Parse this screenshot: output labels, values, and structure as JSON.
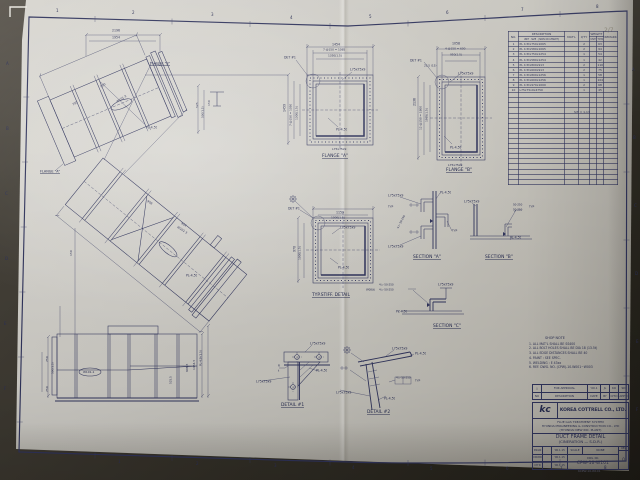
{
  "sheet": {
    "type": "engineering-drawing-photo",
    "border_color": "#30345c",
    "paper_color": "#ceccc6",
    "background_color": "#3a362e"
  },
  "view_labels": [
    {
      "name": "flange-a-label",
      "t": "FLANGE \"A\"",
      "x": 322,
      "y": 154,
      "fs": 4.4
    },
    {
      "name": "flange-b-label",
      "t": "FLANGE \"B\"",
      "x": 446,
      "y": 168,
      "fs": 4.4
    },
    {
      "name": "typ-stiff-detail-label",
      "t": "TYP.STIFF. DETAIL",
      "x": 312,
      "y": 293,
      "fs": 4.4
    },
    {
      "name": "section-a-label",
      "t": "SECTION \"A\"",
      "x": 413,
      "y": 255,
      "fs": 4.4
    },
    {
      "name": "section-b-label",
      "t": "SECTION \"B\"",
      "x": 485,
      "y": 255,
      "fs": 4.4
    },
    {
      "name": "section-c-label",
      "t": "SECTION \"C\"",
      "x": 433,
      "y": 324,
      "fs": 4.4
    },
    {
      "name": "detail-1-label",
      "t": "DETAIL #1",
      "x": 281,
      "y": 403,
      "fs": 4.4
    },
    {
      "name": "detail-2-label",
      "t": "DETAIL #2",
      "x": 367,
      "y": 410,
      "fs": 4.4
    },
    {
      "name": "main-flange-a-callout",
      "t": "FLANGE \"A\"",
      "x": 40,
      "y": 170,
      "fs": 3.4
    },
    {
      "name": "main-flange-b-callout",
      "t": "FLANGE \"B\"",
      "x": 150,
      "y": 62,
      "fs": 3.4
    }
  ],
  "annotations": [
    {
      "t": "1",
      "x": 56,
      "y": 9,
      "fs": 4
    },
    {
      "t": "2",
      "x": 132,
      "y": 11,
      "fs": 4
    },
    {
      "t": "3",
      "x": 211,
      "y": 13,
      "fs": 4
    },
    {
      "t": "4",
      "x": 290,
      "y": 16,
      "fs": 4
    },
    {
      "t": "5",
      "x": 369,
      "y": 15,
      "fs": 4
    },
    {
      "t": "6",
      "x": 446,
      "y": 11,
      "fs": 4
    },
    {
      "t": "7",
      "x": 521,
      "y": 8,
      "fs": 4
    },
    {
      "t": "8",
      "x": 596,
      "y": 5,
      "fs": 4
    },
    {
      "t": "1",
      "x": 118,
      "y": 460,
      "fs": 4
    },
    {
      "t": "2",
      "x": 196,
      "y": 462,
      "fs": 4
    },
    {
      "t": "3",
      "x": 274,
      "y": 464,
      "fs": 4
    },
    {
      "t": "4",
      "x": 352,
      "y": 466,
      "fs": 4
    },
    {
      "t": "5",
      "x": 430,
      "y": 467,
      "fs": 4
    },
    {
      "t": "6",
      "x": 506,
      "y": 467,
      "fs": 4
    },
    {
      "t": "7",
      "x": 560,
      "y": 467,
      "fs": 4
    },
    {
      "t": "8",
      "x": 604,
      "y": 466,
      "fs": 4
    },
    {
      "t": "A",
      "x": 6,
      "y": 62,
      "fs": 4
    },
    {
      "t": "B",
      "x": 6,
      "y": 127,
      "fs": 4
    },
    {
      "t": "C",
      "x": 5,
      "y": 192,
      "fs": 4
    },
    {
      "t": "D",
      "x": 5,
      "y": 257,
      "fs": 4
    },
    {
      "t": "E",
      "x": 4,
      "y": 322,
      "fs": 4
    },
    {
      "t": "F",
      "x": 4,
      "y": 387,
      "fs": 4
    },
    {
      "t": "A",
      "x": 632,
      "y": 68,
      "fs": 4
    },
    {
      "t": "B",
      "x": 633,
      "y": 136,
      "fs": 4
    },
    {
      "t": "C",
      "x": 634,
      "y": 204,
      "fs": 4
    },
    {
      "t": "D",
      "x": 635,
      "y": 272,
      "fs": 4
    },
    {
      "t": "E",
      "x": 636,
      "y": 340,
      "fs": 4
    },
    {
      "t": "F",
      "x": 636,
      "y": 408,
      "fs": 4
    },
    {
      "t": "2/7",
      "x": 604,
      "y": 27,
      "fs": 6,
      "c": "#8f8a7c"
    },
    {
      "t": "2196",
      "x": 112,
      "y": 29,
      "fs": 3.2
    },
    {
      "t": "1954",
      "x": 112,
      "y": 36,
      "fs": 3.2
    },
    {
      "t": "PL-4.5t",
      "x": 146,
      "y": 126,
      "fs": 3.2
    },
    {
      "t": "525",
      "x": 196,
      "y": 108,
      "r": -90,
      "fs": 3
    },
    {
      "t": "500(1.5)",
      "x": 202,
      "y": 118,
      "r": -90,
      "fs": 2.8
    },
    {
      "t": "150",
      "x": 208,
      "y": 106,
      "r": -90,
      "fs": 3
    },
    {
      "t": "W101-2",
      "x": 116,
      "y": 101,
      "r": -33,
      "fs": 3
    },
    {
      "t": "W101-3",
      "x": 178,
      "y": 226,
      "r": 33,
      "fs": 3
    },
    {
      "t": "750",
      "x": 72,
      "y": 104,
      "r": -33,
      "fs": 3
    },
    {
      "t": "500",
      "x": 100,
      "y": 86,
      "r": -33,
      "fs": 3
    },
    {
      "t": "908",
      "x": 148,
      "y": 200,
      "r": 33,
      "fs": 3
    },
    {
      "t": "924",
      "x": 182,
      "y": 222,
      "r": 33,
      "fs": 3
    },
    {
      "t": "PL-4.5t",
      "x": 186,
      "y": 274,
      "fs": 3.2
    },
    {
      "t": "1454",
      "x": 332,
      "y": 43,
      "fs": 3.2
    },
    {
      "t": "7 @150 = 1085",
      "x": 323,
      "y": 49,
      "fs": 2.9
    },
    {
      "t": "1350(1.5)",
      "x": 328,
      "y": 55,
      "fs": 2.9
    },
    {
      "t": "DET #1",
      "x": 284,
      "y": 56,
      "fs": 3.2
    },
    {
      "t": "L75x75x9",
      "x": 350,
      "y": 68,
      "fs": 3.2
    },
    {
      "t": "1459",
      "x": 283,
      "y": 112,
      "r": -90,
      "fs": 3.2
    },
    {
      "t": "7 @150 = 1050",
      "x": 290,
      "y": 126,
      "r": -90,
      "fs": 2.9
    },
    {
      "t": "1300(1.5)",
      "x": 296,
      "y": 120,
      "r": -90,
      "fs": 2.9
    },
    {
      "t": "PL-4.5t",
      "x": 336,
      "y": 128,
      "fs": 3.2
    },
    {
      "t": "L75x75x9",
      "x": 332,
      "y": 148,
      "fs": 3
    },
    {
      "t": "1058",
      "x": 452,
      "y": 42,
      "fs": 3.2
    },
    {
      "t": "4 @150 = 600",
      "x": 445,
      "y": 48,
      "fs": 2.9
    },
    {
      "t": "950(1.5)",
      "x": 450,
      "y": 54,
      "fs": 2.9
    },
    {
      "t": "DET #1",
      "x": 410,
      "y": 59,
      "fs": 3.2
    },
    {
      "t": "25.5 (15)",
      "x": 424,
      "y": 65,
      "fs": 2.8
    },
    {
      "t": "L75x75x9",
      "x": 458,
      "y": 72,
      "fs": 3.2
    },
    {
      "t": "2136",
      "x": 413,
      "y": 106,
      "r": -90,
      "fs": 3.2
    },
    {
      "t": "12 @150 = 1800",
      "x": 420,
      "y": 130,
      "r": -90,
      "fs": 2.9
    },
    {
      "t": "1985(1.5)",
      "x": 426,
      "y": 122,
      "r": -90,
      "fs": 2.9
    },
    {
      "t": "PL-4.5t",
      "x": 450,
      "y": 146,
      "fs": 3.2
    },
    {
      "t": "L75x75x9",
      "x": 448,
      "y": 164,
      "fs": 3
    },
    {
      "t": "1159",
      "x": 336,
      "y": 211,
      "fs": 3.2
    },
    {
      "t": "1000(1.5)",
      "x": 331,
      "y": 217,
      "fs": 2.9
    },
    {
      "t": "DET #1",
      "x": 288,
      "y": 207,
      "fs": 3.2
    },
    {
      "t": "L75x75x9",
      "x": 340,
      "y": 226,
      "fs": 3.2
    },
    {
      "t": "970",
      "x": 293,
      "y": 252,
      "r": -90,
      "fs": 3.2
    },
    {
      "t": "1000(1.5)",
      "x": 299,
      "y": 260,
      "r": -90,
      "fs": 2.9
    },
    {
      "t": "PL-4.5t",
      "x": 338,
      "y": 266,
      "fs": 3.2
    },
    {
      "t": "L75x75x9",
      "x": 388,
      "y": 194,
      "fs": 3.2
    },
    {
      "t": "PL-4.5t",
      "x": 440,
      "y": 191,
      "fs": 3.2
    },
    {
      "t": "TYP",
      "x": 388,
      "y": 206,
      "fs": 2.9
    },
    {
      "t": "TYP",
      "x": 452,
      "y": 230,
      "fs": 2.9
    },
    {
      "t": "4 ▷ 50-250",
      "x": 397,
      "y": 228,
      "r": -62,
      "fs": 2.7
    },
    {
      "t": "L75x75x9",
      "x": 388,
      "y": 245,
      "fs": 3.2
    },
    {
      "t": "L75x75x9",
      "x": 464,
      "y": 200,
      "fs": 3.2
    },
    {
      "t": "50-250",
      "x": 513,
      "y": 204,
      "fs": 2.7
    },
    {
      "t": "50-250",
      "x": 513,
      "y": 209,
      "fs": 2.7
    },
    {
      "t": "TYP",
      "x": 529,
      "y": 206,
      "fs": 2.9
    },
    {
      "t": "PL-4.5t",
      "x": 510,
      "y": 236,
      "fs": 3.2
    },
    {
      "t": "W08(t)",
      "x": 366,
      "y": 289,
      "fs": 2.7
    },
    {
      "t": "4 ▷ 50-250",
      "x": 379,
      "y": 284,
      "fs": 2.7
    },
    {
      "t": "4 ▷ 50-250",
      "x": 379,
      "y": 289,
      "fs": 2.7
    },
    {
      "t": "L75x75x9",
      "x": 438,
      "y": 283,
      "fs": 3.2
    },
    {
      "t": "PL-4.5t",
      "x": 396,
      "y": 310,
      "fs": 3.2
    },
    {
      "t": "L75x75x9",
      "x": 310,
      "y": 342,
      "fs": 3.2
    },
    {
      "t": "R",
      "x": 278,
      "y": 365,
      "fs": 2.9
    },
    {
      "t": "t",
      "x": 278,
      "y": 370,
      "fs": 2.9
    },
    {
      "t": "PL-4.5t",
      "x": 316,
      "y": 369,
      "fs": 3.2
    },
    {
      "t": "L75x75x9",
      "x": 256,
      "y": 380,
      "fs": 3.2
    },
    {
      "t": "L75x75x9",
      "x": 392,
      "y": 347,
      "fs": 3.2
    },
    {
      "t": "PL-4.5t",
      "x": 415,
      "y": 352,
      "fs": 3.2
    },
    {
      "t": "4 ▷ 50-250",
      "x": 396,
      "y": 377,
      "fs": 2.7
    },
    {
      "t": "TYP",
      "x": 415,
      "y": 380,
      "fs": 2.9
    },
    {
      "t": "L75x75x9",
      "x": 336,
      "y": 391,
      "fs": 3.2
    },
    {
      "t": "PL-4.5t",
      "x": 384,
      "y": 397,
      "fs": 3.2
    },
    {
      "t": "150",
      "x": 70,
      "y": 256,
      "r": -90,
      "fs": 3
    },
    {
      "t": "750",
      "x": 46,
      "y": 362,
      "r": -90,
      "fs": 3
    },
    {
      "t": "500(1.5)",
      "x": 52,
      "y": 374,
      "r": -90,
      "fs": 2.8
    },
    {
      "t": "750",
      "x": 46,
      "y": 392,
      "r": -90,
      "fs": 3
    },
    {
      "t": "W101-1",
      "x": 83,
      "y": 371,
      "fs": 3
    },
    {
      "t": "525.5",
      "x": 170,
      "y": 384,
      "r": -90,
      "fs": 2.8
    },
    {
      "t": "908.5",
      "x": 186,
      "y": 372,
      "r": -90,
      "fs": 3
    },
    {
      "t": "1454.5",
      "x": 193,
      "y": 370,
      "r": -90,
      "fs": 3
    },
    {
      "t": "PL-4.5t(1.5)",
      "x": 200,
      "y": 366,
      "r": -90,
      "fs": 2.8
    },
    {
      "t": "KCPW-10-W101",
      "x": 578,
      "y": 470,
      "fs": 3,
      "c": "#5e5e74"
    }
  ],
  "parts_table": {
    "headers": {
      "no": "NO.",
      "description": "DESCRIPTION",
      "desc_sub": "UNIT · SIZE · (SPAN OR LENGTH)",
      "matl": "MAT'L",
      "qty": "Q'TY",
      "weight": "WEIGHT (kg)",
      "unit": "UNIT",
      "total": "TOTAL",
      "remark": "REMARK"
    },
    "rows": [
      {
        "no": "1",
        "desc": "PL 4.5tx750x1065",
        "matl": "",
        "qty": "2",
        "unit": "",
        "total": "63",
        "remark": ""
      },
      {
        "no": "2",
        "desc": "PL 4.5tx580x1065",
        "matl": "",
        "qty": "2",
        "unit": "",
        "total": "94",
        "remark": ""
      },
      {
        "no": "3",
        "desc": "PL 4.5tx750x1254",
        "matl": "",
        "qty": "1",
        "unit": "",
        "total": "54",
        "remark": ""
      },
      {
        "no": "4",
        "desc": "PL 4.5tx580x1254",
        "matl": "",
        "qty": "1",
        "unit": "",
        "total": "42",
        "remark": ""
      },
      {
        "no": "5",
        "desc": "PL 4.5tx800x913",
        "matl": "",
        "qty": "2",
        "unit": "",
        "total": "110",
        "remark": ""
      },
      {
        "no": "6",
        "desc": "PL 4.5tx600x913",
        "matl": "",
        "qty": "2",
        "unit": "",
        "total": "75",
        "remark": ""
      },
      {
        "no": "7",
        "desc": "PL 4.5tx800x1256",
        "matl": "",
        "qty": "1",
        "unit": "",
        "total": "58",
        "remark": ""
      },
      {
        "no": "8",
        "desc": "PL 4.5tx600x1256",
        "matl": "",
        "qty": "1",
        "unit": "",
        "total": "104",
        "remark": ""
      },
      {
        "no": "9",
        "desc": "PL 4.5tx970x1000",
        "matl": "",
        "qty": "2",
        "unit": "",
        "total": "68",
        "remark": ""
      },
      {
        "no": "10",
        "desc": "L75x75x9x4750",
        "matl": "",
        "qty": "1",
        "unit": "",
        "total": "45",
        "remark": ""
      }
    ],
    "empty_rows": 18,
    "total_note": "S/T = 1.13"
  },
  "shop_notes": {
    "title": "SHOP NOTE",
    "items": [
      "1. ALL MAT'L SHALL BE SS400",
      "2. ALL BOLT HOLES SHALL BE DIA 18 (13.5t)",
      "3. ALL EDGE DISTANCES SHALL BE 40",
      "4. PAINT : SEE SPEC.",
      "5. WELDING : E 43xx",
      "6. REF. DWG. NO. (CPW)-10-W001~W003"
    ]
  },
  "title_block": {
    "rev1": {
      "sym": "△",
      "text": "FOR APPROVAL",
      "date": "'00.1",
      "by": "JL",
      "chk": "KO",
      "app": "SD"
    },
    "rev2": {
      "sym": "NO",
      "text": "DESCRIPTION",
      "date": "DATE",
      "by": "BY",
      "chk": "CH'D",
      "app": "APP'D"
    },
    "logo": "kc",
    "company": "KOREA COTTRELL CO., LTD.",
    "project1": "FLUE GAS TREATMENT SYSTEM",
    "project2": "HYUNDAI ENGINEERING & CONSTRUCTION CO., LTD",
    "project3": "(HYUNDAI NEW INC. PLANT)",
    "title1": "DUCT FRAME DETAIL",
    "title2": "(CINERATION — S.D.R.)",
    "signs": [
      [
        "DSGN",
        "·",
        "'00.1.15"
      ],
      [
        "DRWN",
        "·",
        "'00.1.15"
      ],
      [
        "CH'D",
        "·",
        "'00.1.15"
      ]
    ],
    "scale_label": "SCALE",
    "scale_value": "NONE",
    "dwg_label": "DWG. NO.",
    "dwg_no": "CPW-10-W101",
    "rev_label": "REV",
    "rev_value": "0"
  }
}
